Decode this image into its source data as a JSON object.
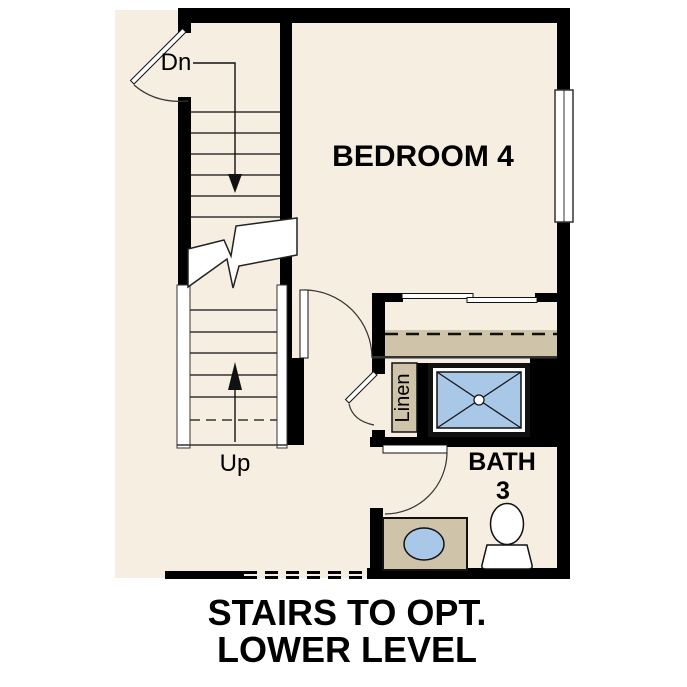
{
  "plan": {
    "labels": {
      "dn": "Dn",
      "up": "Up",
      "bedroom": "BEDROOM 4",
      "linen": "Linen",
      "bath": "BATH",
      "bath_number": "3"
    },
    "caption": {
      "line1": "STAIRS TO OPT.",
      "line2": "LOWER LEVEL"
    },
    "colors": {
      "floor": "#f5eee1",
      "wall": "#000000",
      "cabinet_tan": "#cfc3aa",
      "fixture_blue": "#a9c8e8",
      "line": "#333333"
    }
  }
}
